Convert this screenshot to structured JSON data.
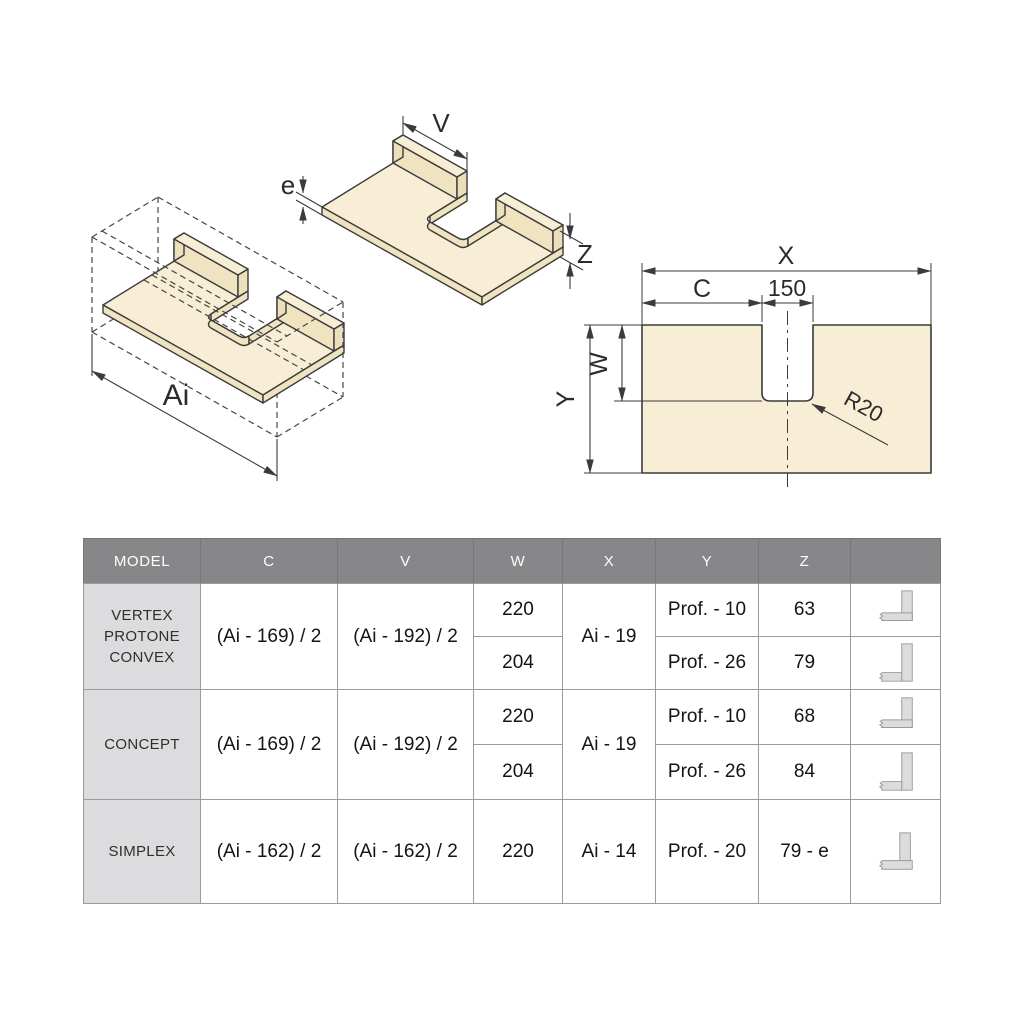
{
  "drawings": {
    "cabinet_iso": {
      "dim_ai": "Ai"
    },
    "panel_iso": {
      "dim_v": "V",
      "dim_e": "e",
      "dim_z": "Z"
    },
    "plan_view": {
      "dim_x": "X",
      "dim_c": "C",
      "dim_150": "150",
      "dim_w": "W",
      "dim_y": "Y",
      "dim_r20": "R20"
    }
  },
  "colors": {
    "panel_fill": "#f7eed5",
    "panel_edge": "#f0e3c0",
    "drawing_line": "#3b3b3b",
    "table_header_bg": "#87878a",
    "table_header_text": "#ffffff",
    "model_col_bg": "#dcdcde",
    "table_border": "#9b9b9d",
    "icon_fill": "#dcdcde",
    "icon_stroke": "#9a9a9c"
  },
  "table": {
    "headers": [
      "MODEL",
      "C",
      "V",
      "W",
      "X",
      "Y",
      "Z",
      ""
    ],
    "rows": [
      {
        "model_lines": [
          "VERTEX",
          "PROTONE",
          "CONVEX"
        ],
        "c": "(Ai - 169) / 2",
        "v": "(Ai - 192) / 2",
        "x": "Ai - 19",
        "sub": [
          {
            "w": "220",
            "y": "Prof. - 10",
            "z": "63",
            "icon": "profile-overlap-section-icon"
          },
          {
            "w": "204",
            "y": "Prof. - 26",
            "z": "79",
            "icon": "profile-butt-section-icon"
          }
        ]
      },
      {
        "model_lines": [
          "CONCEPT"
        ],
        "c": "(Ai - 169) / 2",
        "v": "(Ai - 192) / 2",
        "x": "Ai - 19",
        "sub": [
          {
            "w": "220",
            "y": "Prof. - 10",
            "z": "68",
            "icon": "profile-overlap-section-icon"
          },
          {
            "w": "204",
            "y": "Prof. - 26",
            "z": "84",
            "icon": "profile-butt-section-icon"
          }
        ]
      },
      {
        "model_lines": [
          "SIMPLEX"
        ],
        "c": "(Ai - 162) / 2",
        "v": "(Ai - 162) / 2",
        "x": "Ai - 14",
        "sub": [
          {
            "w": "220",
            "y": "Prof. - 20",
            "z": "79 - e",
            "icon": "profile-on-top-section-icon"
          }
        ]
      }
    ]
  }
}
